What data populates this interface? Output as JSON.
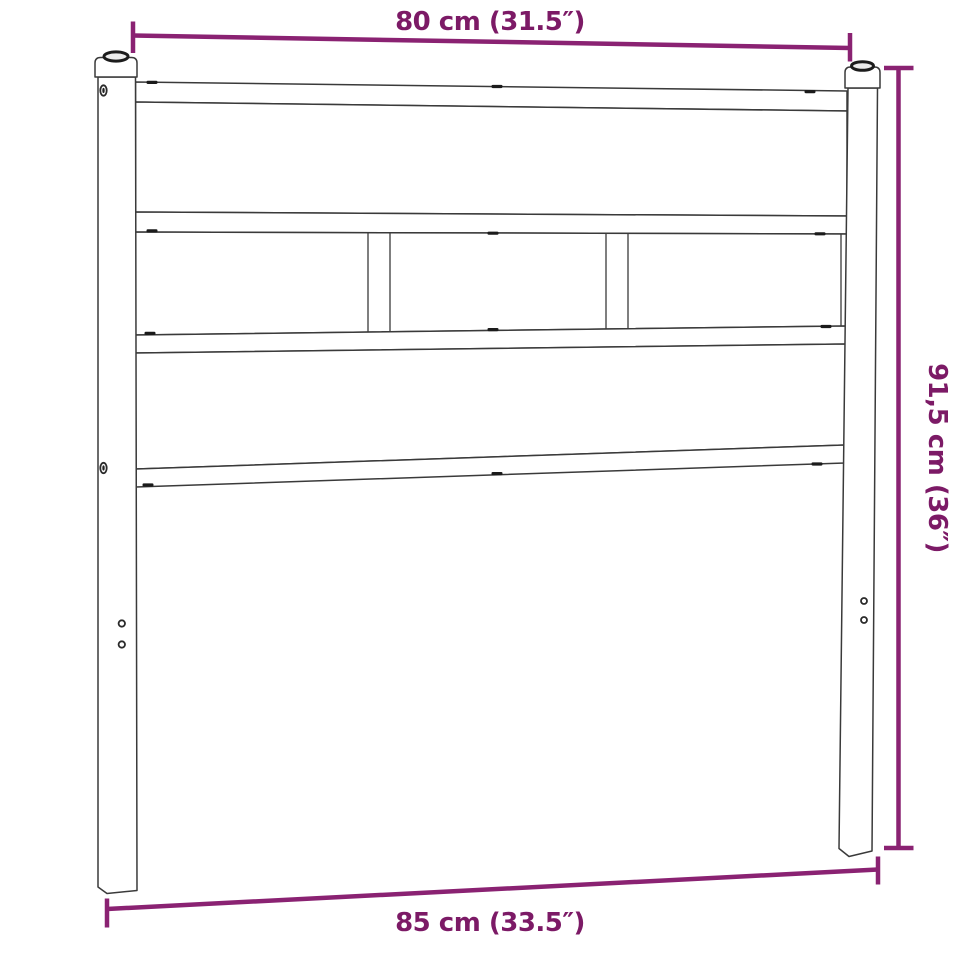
{
  "image": {
    "title": "Metal headboard with wooden posts - dimension diagram",
    "background_color": "#ffffff"
  },
  "colors": {
    "dimension_line": "#8A2272",
    "dimension_text": "#7C1A66",
    "drawing_line": "#3A3A3A"
  },
  "dimensions": {
    "top_width": {
      "label": "80 cm (31.5″)",
      "position": "top"
    },
    "right_height": {
      "label": "91,5 cm (36″)",
      "position": "right"
    },
    "bottom_width": {
      "label": "85 cm (33.5″)",
      "position": "bottom"
    }
  }
}
